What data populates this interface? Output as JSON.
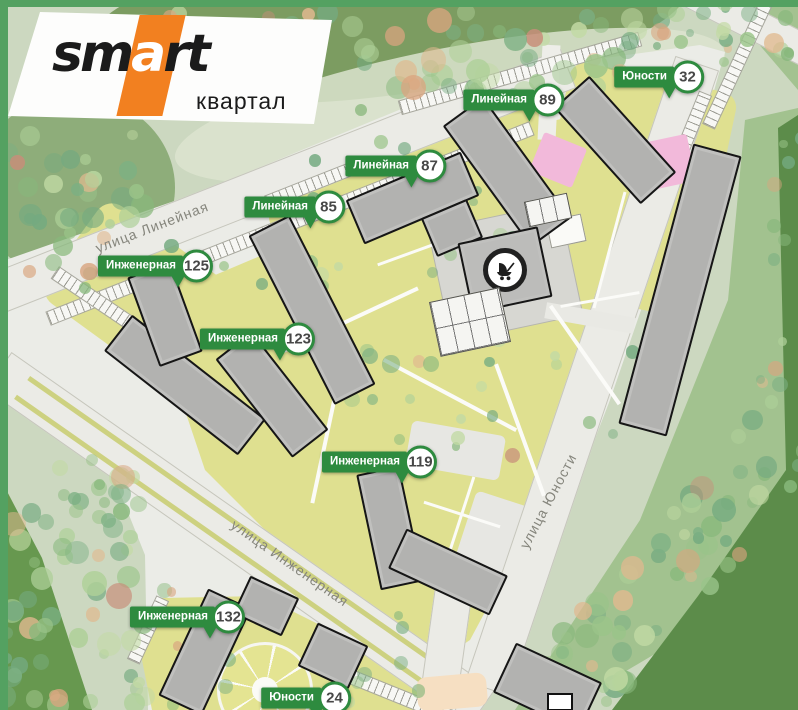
{
  "logo": {
    "brand_prefix": "sm",
    "brand_accent": "a",
    "brand_suffix": "rt",
    "subtitle": "квартал"
  },
  "map": {
    "pins": [
      {
        "street": "Линейная",
        "number": "89",
        "x": 547,
        "y": 100
      },
      {
        "street": "Юности",
        "number": "32",
        "x": 687,
        "y": 77
      },
      {
        "street": "Линейная",
        "number": "87",
        "x": 429,
        "y": 166
      },
      {
        "street": "Линейная",
        "number": "85",
        "x": 328,
        "y": 207
      },
      {
        "street": "Инженерная",
        "number": "125",
        "x": 196,
        "y": 266
      },
      {
        "street": "Инженерная",
        "number": "123",
        "x": 298,
        "y": 339
      },
      {
        "street": "Инженерная",
        "number": "119",
        "x": 420,
        "y": 462
      },
      {
        "street": "Инженерная",
        "number": "132",
        "x": 228,
        "y": 617
      },
      {
        "street": "Юности",
        "number": "24",
        "x": 334,
        "y": 698
      }
    ],
    "street_labels": [
      {
        "text": "улица Линейная",
        "x": 152,
        "y": 227,
        "angle": -21
      },
      {
        "text": "улица Инженерная",
        "x": 290,
        "y": 563,
        "angle": 35
      },
      {
        "text": "улица Юности",
        "x": 548,
        "y": 501,
        "angle": -62
      }
    ],
    "poi": [
      {
        "icon": "stroller-icon"
      }
    ]
  },
  "colors": {
    "pin_green": "#2e8b3f",
    "accent_orange": "#f28020",
    "building_gray": "#b2b2b0",
    "lawn_yellow": "#dfe090",
    "park_dark": "#5c8c4a",
    "park_mid": "#a2c28f",
    "park_pale": "#ccd8c0",
    "road_gray": "#ebebe6",
    "playground_pink": "#f2b9da"
  }
}
